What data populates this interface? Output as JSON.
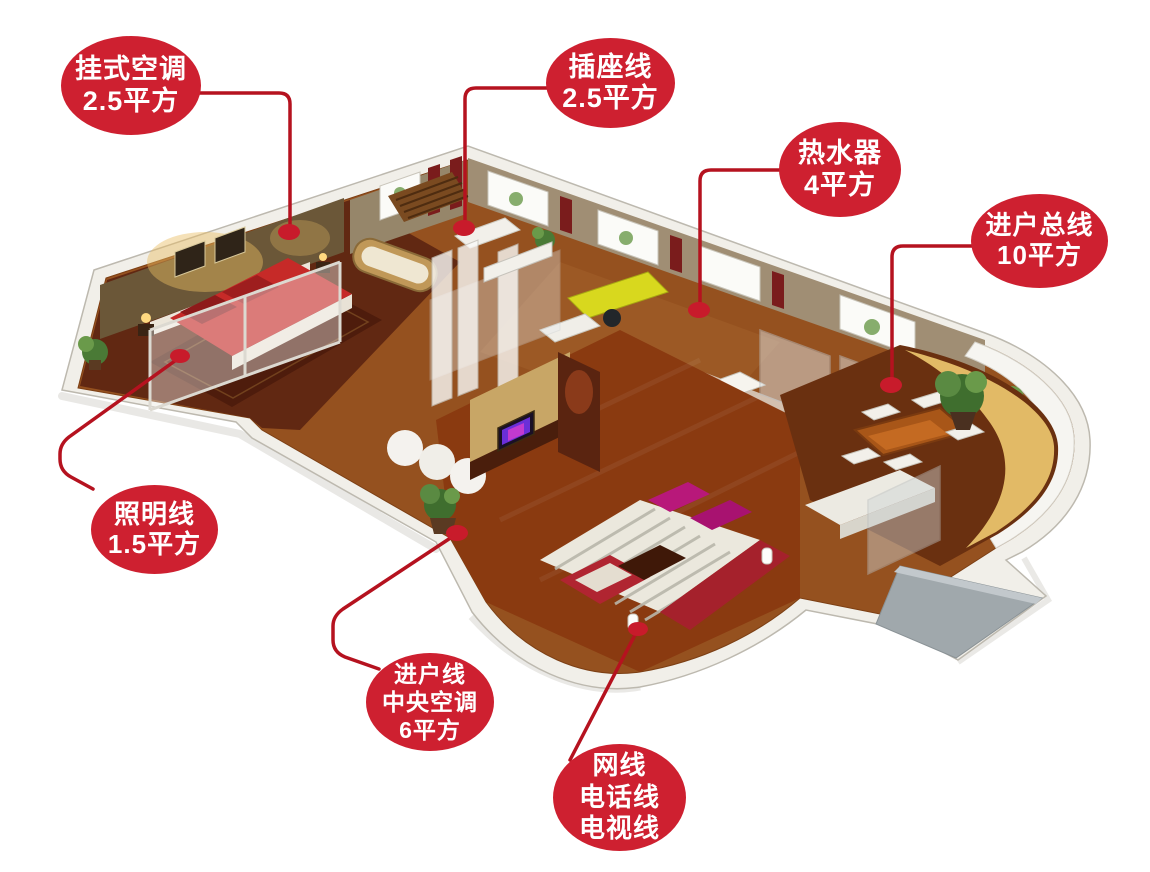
{
  "colors": {
    "callout_fill": "#ce2030",
    "connector_line": "#b5121f",
    "callout_text": "#ffffff"
  },
  "callouts": [
    {
      "name": "wall-ac",
      "lines": [
        "挂式空调",
        "2.5平方"
      ]
    },
    {
      "name": "socket-line",
      "lines": [
        "插座线",
        "2.5平方"
      ]
    },
    {
      "name": "water-heater",
      "lines": [
        "热水器",
        "4平方"
      ]
    },
    {
      "name": "entry-main-line",
      "lines": [
        "进户总线",
        "10平方"
      ]
    },
    {
      "name": "lighting-line",
      "lines": [
        "照明线",
        "1.5平方"
      ]
    },
    {
      "name": "entry-central-ac",
      "lines": [
        "进户线",
        "中央空调",
        "6平方"
      ]
    },
    {
      "name": "signal-lines",
      "lines": [
        "网线",
        "电话线",
        "电视线"
      ]
    }
  ]
}
